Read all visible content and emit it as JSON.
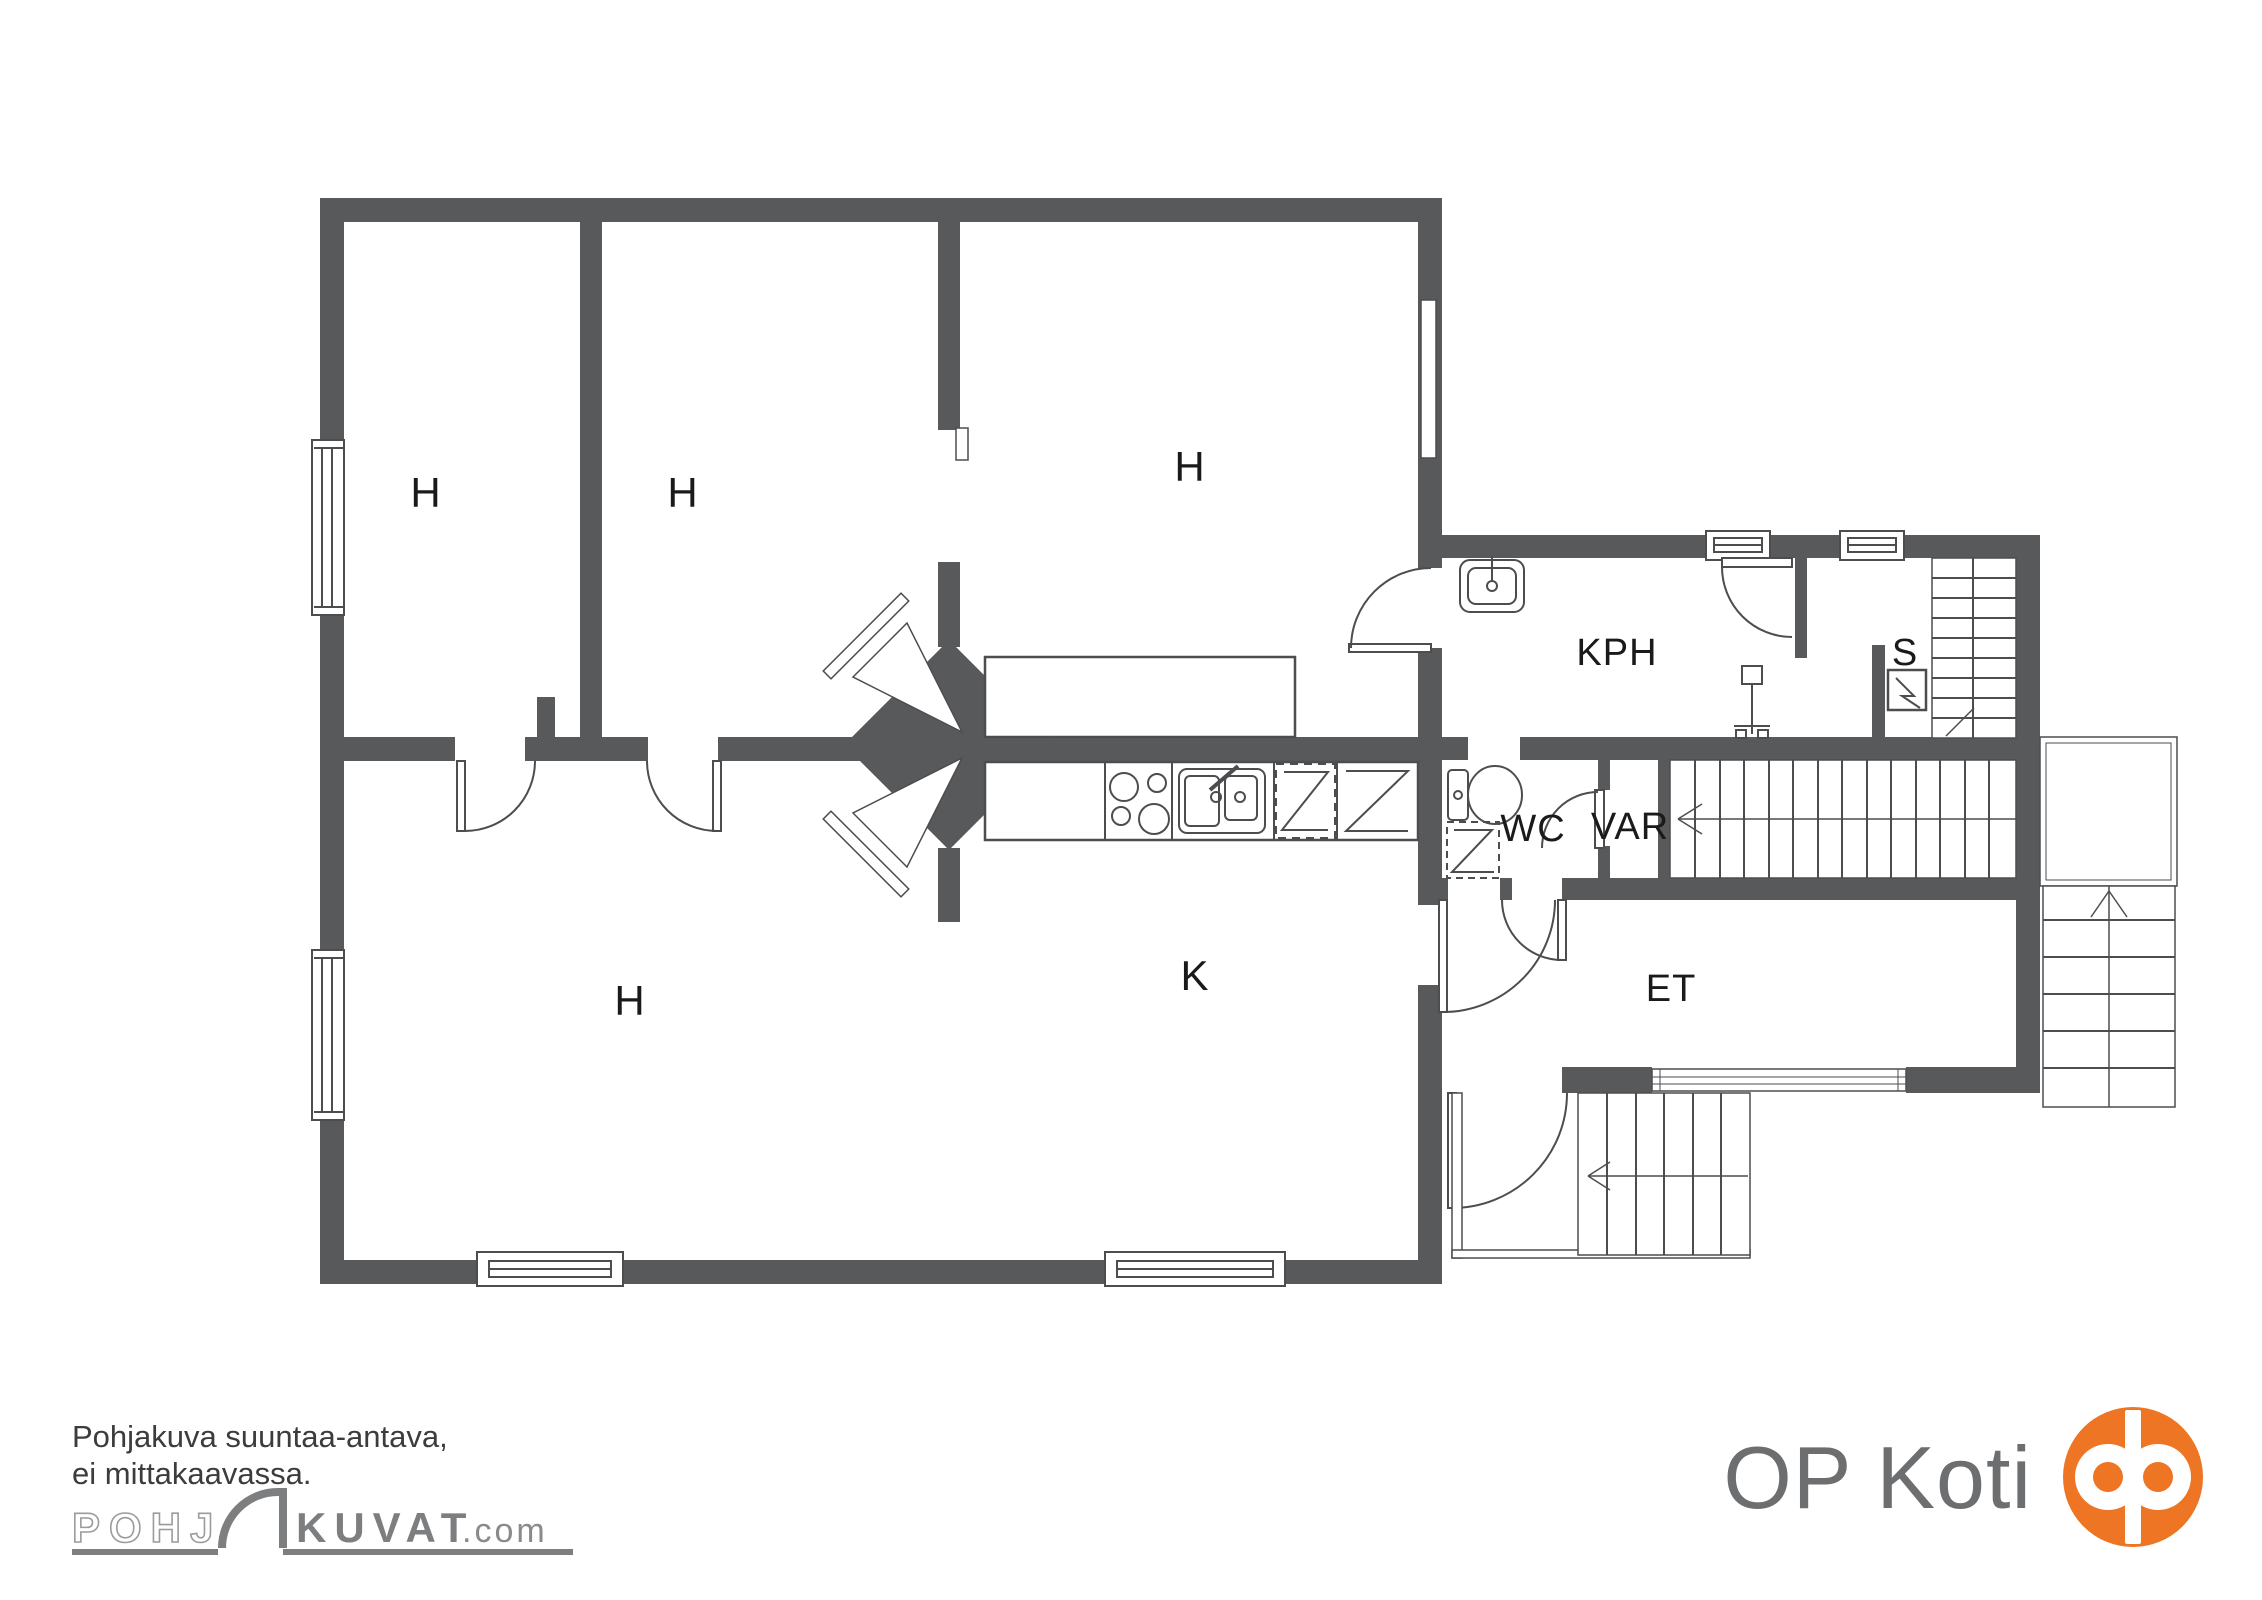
{
  "floor_plan": {
    "type": "apartment-floor-plan",
    "rooms": [
      {
        "id": "room-top-left",
        "label": "H"
      },
      {
        "id": "room-top-middle",
        "label": "H"
      },
      {
        "id": "room-top-right",
        "label": "H"
      },
      {
        "id": "room-bottom-left",
        "label": "H"
      },
      {
        "id": "kitchen",
        "label": "K"
      },
      {
        "id": "bathroom",
        "label": "KPH"
      },
      {
        "id": "sauna",
        "label": "S"
      },
      {
        "id": "toilet-room",
        "label": "WC"
      },
      {
        "id": "storage",
        "label": "VAR"
      },
      {
        "id": "entrance-hall",
        "label": "ET"
      }
    ],
    "colors": {
      "wall": "#58595b",
      "line": "#4d4d50",
      "label": "#1a1a1a"
    },
    "icons": {
      "sink": "rounded-basin-with-faucet",
      "shower-mixer": "stem-with-valve-head",
      "sauna-stove": "square-with-lightning-zigzag",
      "toilet": "tank-and-bowl-ellipse",
      "washing-machine": "dashed-square-with-zigzag",
      "stove": "four-burner-circles",
      "kitchen-sink": "double-basin-with-faucet",
      "dishwasher": "dashed-square-with-z-line",
      "fridge": "square-with-z-line",
      "fireplace": "diagonal-chimney-mass-with-two-hearths",
      "stairs": "parallel-tread-lines-with-direction-arrow",
      "window": "white-bar-with-inner-lines",
      "door": "quarter-circle-swing-arc"
    }
  },
  "footer": {
    "disclaimer_line1": "Pohjakuva suuntaa-antava,",
    "disclaimer_line2": "ei mittakaavassa.",
    "watermark": {
      "outline_part": "POHJ",
      "solid_part": "KUVAT",
      "suffix": ".com",
      "symbol": "door-arc-icon"
    },
    "brand": {
      "name": "OP Koti",
      "logo": "op-rings-icon",
      "logo_color": "#ee7523",
      "text_color": "#6d6e70"
    }
  }
}
